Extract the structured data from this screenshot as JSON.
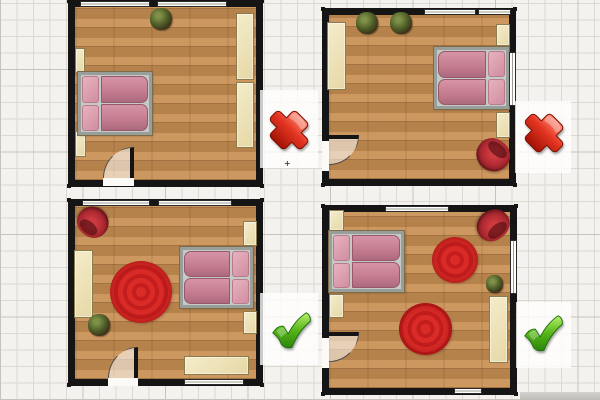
{
  "app": {
    "description": "Bedroom floor plan comparison: two layouts marked wrong (red cross), two marked correct (green check)",
    "canvas": {
      "w": 600,
      "h": 400
    }
  },
  "palette": {
    "background": "#f4f2ee",
    "grid_line": "#dcd8d2",
    "grid_major": "#c7c3bc",
    "wall": "#151515",
    "floor_light": "#cd9760",
    "floor_mid": "#b5824b",
    "furniture_cream": "#eee3ba",
    "bed_pink": "#c57d91",
    "pillow_pink": "#d08ea0",
    "rug_red": "#d62828",
    "chair_red": "#a2242c",
    "plant_green": "#4d5c27",
    "cross_red": "#da2b17",
    "check_green": "#49ad17"
  },
  "rooms": [
    {
      "id": "top-left",
      "verdict": "cross",
      "outer": {
        "x": 68,
        "y": 0,
        "w": 195,
        "h": 187
      },
      "windows": [
        {
          "x": 80,
          "y": 1,
          "w": 70,
          "h": 6,
          "dir": "h"
        },
        {
          "x": 157,
          "y": 1,
          "w": 70,
          "h": 6,
          "dir": "h"
        }
      ],
      "door": {
        "gap": {
          "x": 103,
          "y": 178,
          "w": 31,
          "h": 8
        },
        "swing": {
          "x": 103,
          "y": 147,
          "w": 31,
          "h": 31,
          "quad": "q-tl",
          "leaf": "leaf-right"
        }
      },
      "furniture": [
        {
          "type": "plant",
          "name": "potted-plant",
          "x": 150,
          "y": 8,
          "w": 22,
          "h": 22
        },
        {
          "type": "cream",
          "name": "wardrobe",
          "x": 236,
          "y": 13,
          "w": 18,
          "h": 67
        },
        {
          "type": "cream",
          "name": "wardrobe",
          "x": 236,
          "y": 82,
          "w": 18,
          "h": 66
        },
        {
          "type": "cream",
          "name": "shelf",
          "x": 75,
          "y": 48,
          "w": 10,
          "h": 25
        },
        {
          "type": "cream",
          "name": "shelf",
          "x": 75,
          "y": 131,
          "w": 11,
          "h": 26
        },
        {
          "type": "bed",
          "name": "double-bed",
          "x": 78,
          "y": 72,
          "w": 74,
          "h": 63,
          "orient": "left"
        }
      ]
    },
    {
      "id": "top-right",
      "verdict": "cross",
      "outer": {
        "x": 322,
        "y": 8,
        "w": 194,
        "h": 178
      },
      "windows": [
        {
          "x": 424,
          "y": 9,
          "w": 52,
          "h": 6,
          "dir": "h"
        },
        {
          "x": 478,
          "y": 9,
          "w": 33,
          "h": 6,
          "dir": "h"
        },
        {
          "x": 509,
          "y": 52,
          "w": 7,
          "h": 54,
          "dir": "v"
        }
      ],
      "door": {
        "gap": {
          "x": 322,
          "y": 141,
          "w": 7,
          "h": 30
        },
        "swing": {
          "x": 329,
          "y": 135,
          "w": 30,
          "h": 30,
          "quad": "q-br",
          "leaf": "leaf-top"
        }
      },
      "furniture": [
        {
          "type": "plant",
          "name": "potted-plant",
          "x": 356,
          "y": 12,
          "w": 22,
          "h": 22
        },
        {
          "type": "plant",
          "name": "potted-plant",
          "x": 390,
          "y": 12,
          "w": 22,
          "h": 22
        },
        {
          "type": "cream",
          "name": "wardrobe",
          "x": 327,
          "y": 22,
          "w": 19,
          "h": 68
        },
        {
          "type": "bed",
          "name": "double-bed",
          "x": 434,
          "y": 47,
          "w": 75,
          "h": 62,
          "orient": "right"
        },
        {
          "type": "cream",
          "name": "nightstand",
          "x": 496,
          "y": 24,
          "w": 14,
          "h": 22
        },
        {
          "type": "cream",
          "name": "nightstand",
          "x": 496,
          "y": 112,
          "w": 14,
          "h": 26
        },
        {
          "type": "chair",
          "name": "armchair",
          "x": 476,
          "y": 139,
          "w": 34,
          "h": 32,
          "rot": 40
        }
      ]
    },
    {
      "id": "bottom-left",
      "verdict": "check",
      "outer": {
        "x": 68,
        "y": 199,
        "w": 195,
        "h": 187
      },
      "windows": [
        {
          "x": 82,
          "y": 200,
          "w": 68,
          "h": 6,
          "dir": "h"
        },
        {
          "x": 158,
          "y": 200,
          "w": 74,
          "h": 6,
          "dir": "h"
        },
        {
          "x": 184,
          "y": 379,
          "w": 60,
          "h": 6,
          "dir": "h"
        }
      ],
      "door": {
        "gap": {
          "x": 108,
          "y": 378,
          "w": 30,
          "h": 8
        },
        "swing": {
          "x": 108,
          "y": 347,
          "w": 30,
          "h": 31,
          "quad": "q-tl",
          "leaf": "leaf-right"
        }
      },
      "furniture": [
        {
          "type": "chair",
          "name": "armchair",
          "x": 77,
          "y": 207,
          "w": 32,
          "h": 30,
          "rot": -140
        },
        {
          "type": "cream",
          "name": "wardrobe",
          "x": 74,
          "y": 250,
          "w": 19,
          "h": 68
        },
        {
          "type": "plant",
          "name": "potted-plant",
          "x": 88,
          "y": 314,
          "w": 22,
          "h": 22
        },
        {
          "type": "rug",
          "name": "round-rug",
          "x": 110,
          "y": 261,
          "w": 62,
          "h": 62
        },
        {
          "type": "bed",
          "name": "double-bed",
          "x": 180,
          "y": 247,
          "w": 73,
          "h": 61,
          "orient": "right"
        },
        {
          "type": "cream",
          "name": "nightstand",
          "x": 243,
          "y": 221,
          "w": 14,
          "h": 25
        },
        {
          "type": "cream",
          "name": "nightstand",
          "x": 243,
          "y": 311,
          "w": 14,
          "h": 23
        },
        {
          "type": "cream",
          "name": "bench",
          "x": 184,
          "y": 356,
          "w": 65,
          "h": 19
        }
      ]
    },
    {
      "id": "bottom-right",
      "verdict": "check",
      "outer": {
        "x": 322,
        "y": 205,
        "w": 195,
        "h": 190
      },
      "windows": [
        {
          "x": 385,
          "y": 206,
          "w": 64,
          "h": 6,
          "dir": "h"
        },
        {
          "x": 510,
          "y": 240,
          "w": 7,
          "h": 54,
          "dir": "v"
        },
        {
          "x": 454,
          "y": 388,
          "w": 28,
          "h": 6,
          "dir": "h"
        }
      ],
      "door": {
        "gap": {
          "x": 322,
          "y": 338,
          "w": 7,
          "h": 30
        },
        "swing": {
          "x": 329,
          "y": 332,
          "w": 30,
          "h": 30,
          "quad": "q-br",
          "leaf": "leaf-top"
        }
      },
      "furniture": [
        {
          "type": "cream",
          "name": "nightstand",
          "x": 329,
          "y": 210,
          "w": 15,
          "h": 21
        },
        {
          "type": "bed",
          "name": "double-bed",
          "x": 329,
          "y": 231,
          "w": 75,
          "h": 61,
          "orient": "left"
        },
        {
          "type": "cream",
          "name": "nightstand",
          "x": 329,
          "y": 294,
          "w": 15,
          "h": 24
        },
        {
          "type": "chair",
          "name": "armchair",
          "x": 476,
          "y": 210,
          "w": 34,
          "h": 30,
          "rot": 140
        },
        {
          "type": "rug",
          "name": "round-rug",
          "x": 432,
          "y": 237,
          "w": 46,
          "h": 46
        },
        {
          "type": "rug",
          "name": "round-rug",
          "x": 399,
          "y": 303,
          "w": 53,
          "h": 52
        },
        {
          "type": "plant",
          "name": "potted-plant",
          "x": 486,
          "y": 275,
          "w": 17,
          "h": 18
        },
        {
          "type": "cream",
          "name": "wardrobe",
          "x": 489,
          "y": 296,
          "w": 19,
          "h": 67
        }
      ]
    }
  ],
  "marks": [
    {
      "type": "cross",
      "patch": {
        "x": 260,
        "y": 90,
        "w": 58,
        "h": 78
      },
      "icon": {
        "x": 266,
        "y": 107,
        "size": 46
      }
    },
    {
      "type": "cross",
      "patch": {
        "x": 515,
        "y": 101,
        "w": 56,
        "h": 72
      },
      "icon": {
        "x": 521,
        "y": 110,
        "size": 46
      }
    },
    {
      "type": "check",
      "patch": {
        "x": 260,
        "y": 293,
        "w": 58,
        "h": 72
      },
      "icon": {
        "x": 268,
        "y": 307,
        "size": 46
      }
    },
    {
      "type": "check",
      "patch": {
        "x": 516,
        "y": 302,
        "w": 55,
        "h": 66
      },
      "icon": {
        "x": 520,
        "y": 310,
        "size": 46
      }
    }
  ],
  "misc": {
    "move_glyph": {
      "x": 284,
      "y": 160,
      "label": "+"
    },
    "gray_bar": {
      "x": 520,
      "y": 392,
      "w": 80,
      "h": 8
    }
  }
}
